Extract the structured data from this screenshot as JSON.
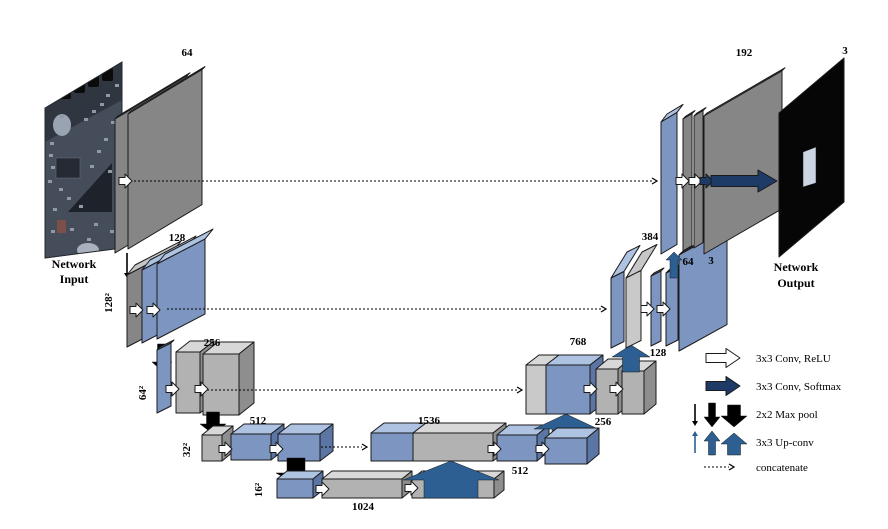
{
  "figure": {
    "type": "U-Net architecture diagram",
    "input_label_line1": "Network",
    "input_label_line2": "Input",
    "output_label_line1": "Network",
    "output_label_line2": "Output"
  },
  "blocks": {
    "enc_row1": {
      "channels": "64"
    },
    "enc_row2": {
      "channels": "128",
      "size": "128²"
    },
    "enc_row3": {
      "channels": "256",
      "size": "64²"
    },
    "enc_row4": {
      "channels": "512",
      "size": "32²"
    },
    "bottleneck": {
      "channels": "1024",
      "size": "16²"
    },
    "dec_row4": {
      "concat": "1536",
      "conv": "512",
      "up": "256"
    },
    "dec_row3": {
      "concat": "768",
      "up": "128"
    },
    "dec_row2": {
      "concat": "384",
      "conv1": "64",
      "conv2": "3"
    },
    "dec_row1": {
      "concat": "192"
    },
    "output": {
      "channels": "3"
    }
  },
  "legend": {
    "conv_relu": "3x3 Conv, ReLU",
    "conv_softmax": "3x3 Conv, Softmax",
    "max_pool": "2x2 Max pool",
    "up_conv": "3x3 Up-conv",
    "concatenate": "concatenate"
  },
  "colors": {
    "plane_gray": "#868686",
    "plane_gray_top": "#c6c6c6",
    "box_gray": "#b2b2b2",
    "box_gray_top": "#d8d8d8",
    "box_gray_side": "#8e8e8e",
    "light_gray": "#c9c9c9",
    "blue": "#7d95c1",
    "blue_top": "#aec2e1",
    "blue_side": "#5b76a4",
    "navy": "#1e3a66",
    "steel_blue": "#2d5f92",
    "outline": "#1a1a1a"
  }
}
